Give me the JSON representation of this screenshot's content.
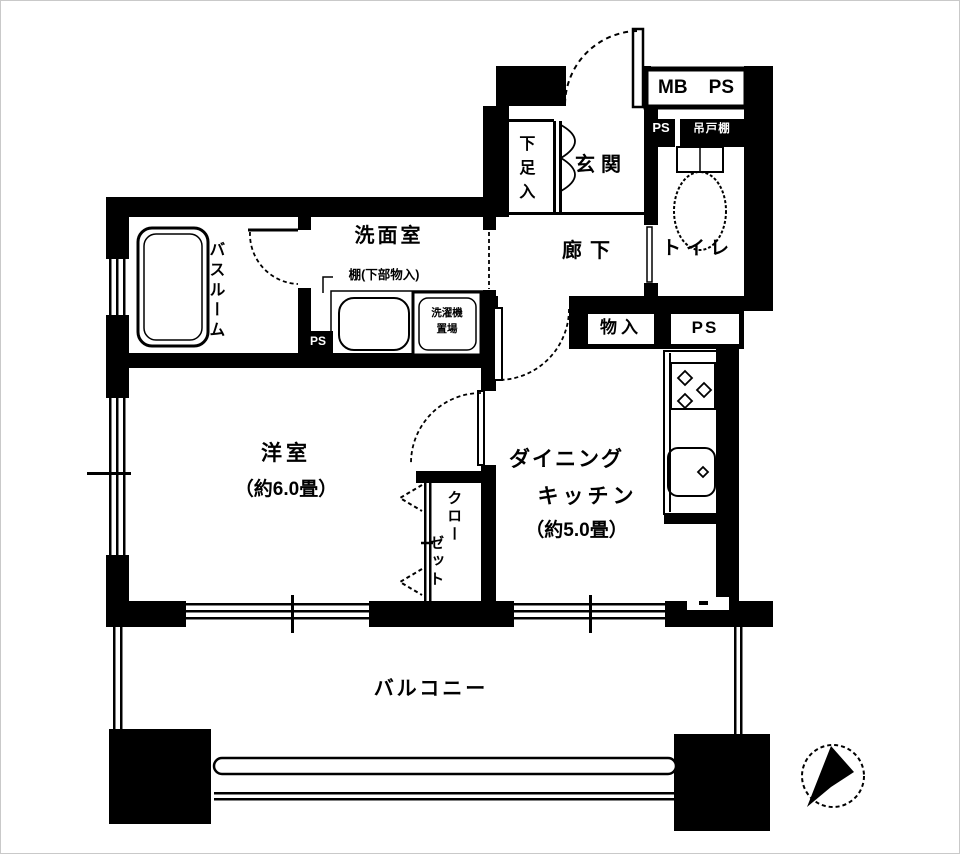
{
  "plan": {
    "type": "japanese-apartment-floorplan",
    "ink_color": "#000000",
    "bg_color": "#ffffff",
    "labels": {
      "mb": "MB",
      "ps_meter": "PS",
      "ps_shaft_top": "PS",
      "hanging_cupboard": "吊戸棚",
      "shoe_cabinet": "下足入",
      "entrance": "玄関",
      "hallway": "廊下",
      "toilet": "トイレ",
      "washroom": "洗面室",
      "washroom_note": "棚(下部物入)",
      "laundry_line1": "洗濯機",
      "laundry_line2": "置場",
      "ps_washroom": "PS",
      "bathroom": "バスルーム",
      "storage": "物入",
      "ps_kitchen": "PS",
      "western_room": "洋室",
      "western_room_size": "（約6.0畳）",
      "dk_line1": "ダイニング",
      "dk_line2": "キッチン",
      "dk_size": "（約5.0畳）",
      "closet_col1": "クロー",
      "closet_col2": "ゼット",
      "balcony": "バルコニー"
    }
  }
}
